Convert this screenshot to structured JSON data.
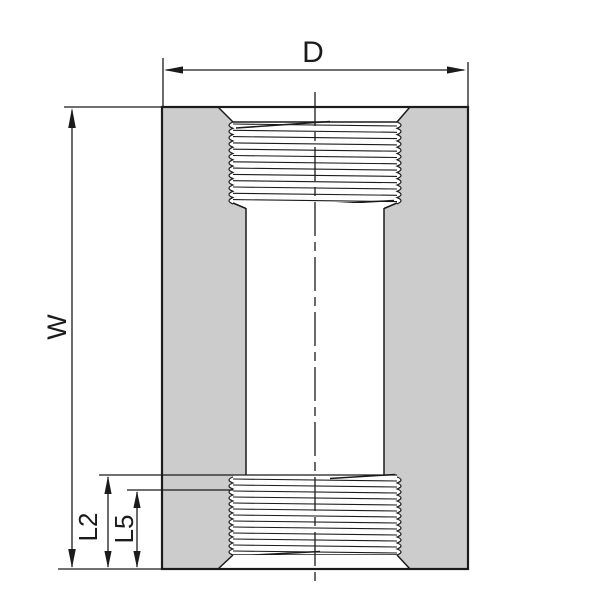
{
  "labels": {
    "d": "D",
    "w": "W",
    "l2": "L2",
    "l5": "L5"
  },
  "colors": {
    "background": "#ffffff",
    "body_fill": "#cccccc",
    "line_color": "#1b1b1b"
  }
}
